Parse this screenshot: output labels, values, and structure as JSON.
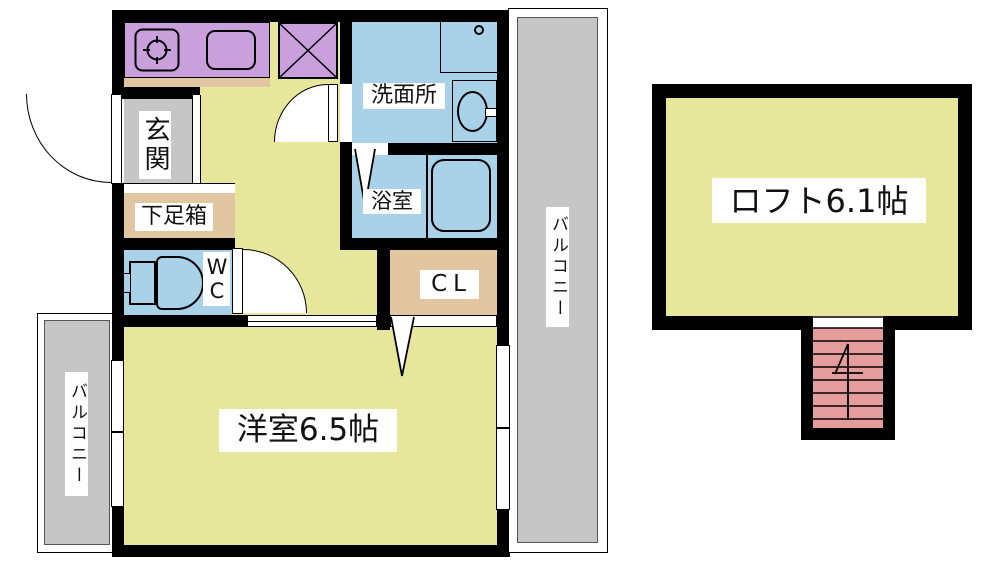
{
  "plan": {
    "floor1": {
      "entrance": "玄関",
      "shoe_cabinet": "下足箱",
      "toilet": "WC",
      "washroom": "洗面所",
      "bathroom": "浴室",
      "closet": "CL",
      "main_room": "洋室6.5帖",
      "balcony_left": "バルコニー",
      "balcony_right": "バルコニー"
    },
    "loft_floor": {
      "loft": "ロフト6.1帖"
    }
  },
  "colors": {
    "room_yellow": "#E6E79B",
    "wet_area_blue": "#A9D2E8",
    "kitchen_purple": "#C9A0DC",
    "storage_tan": "#E2C6A2",
    "balcony_gray": "#C6C6C6",
    "stairs_pink": "#E59C9C",
    "wall_black": "#000000"
  }
}
